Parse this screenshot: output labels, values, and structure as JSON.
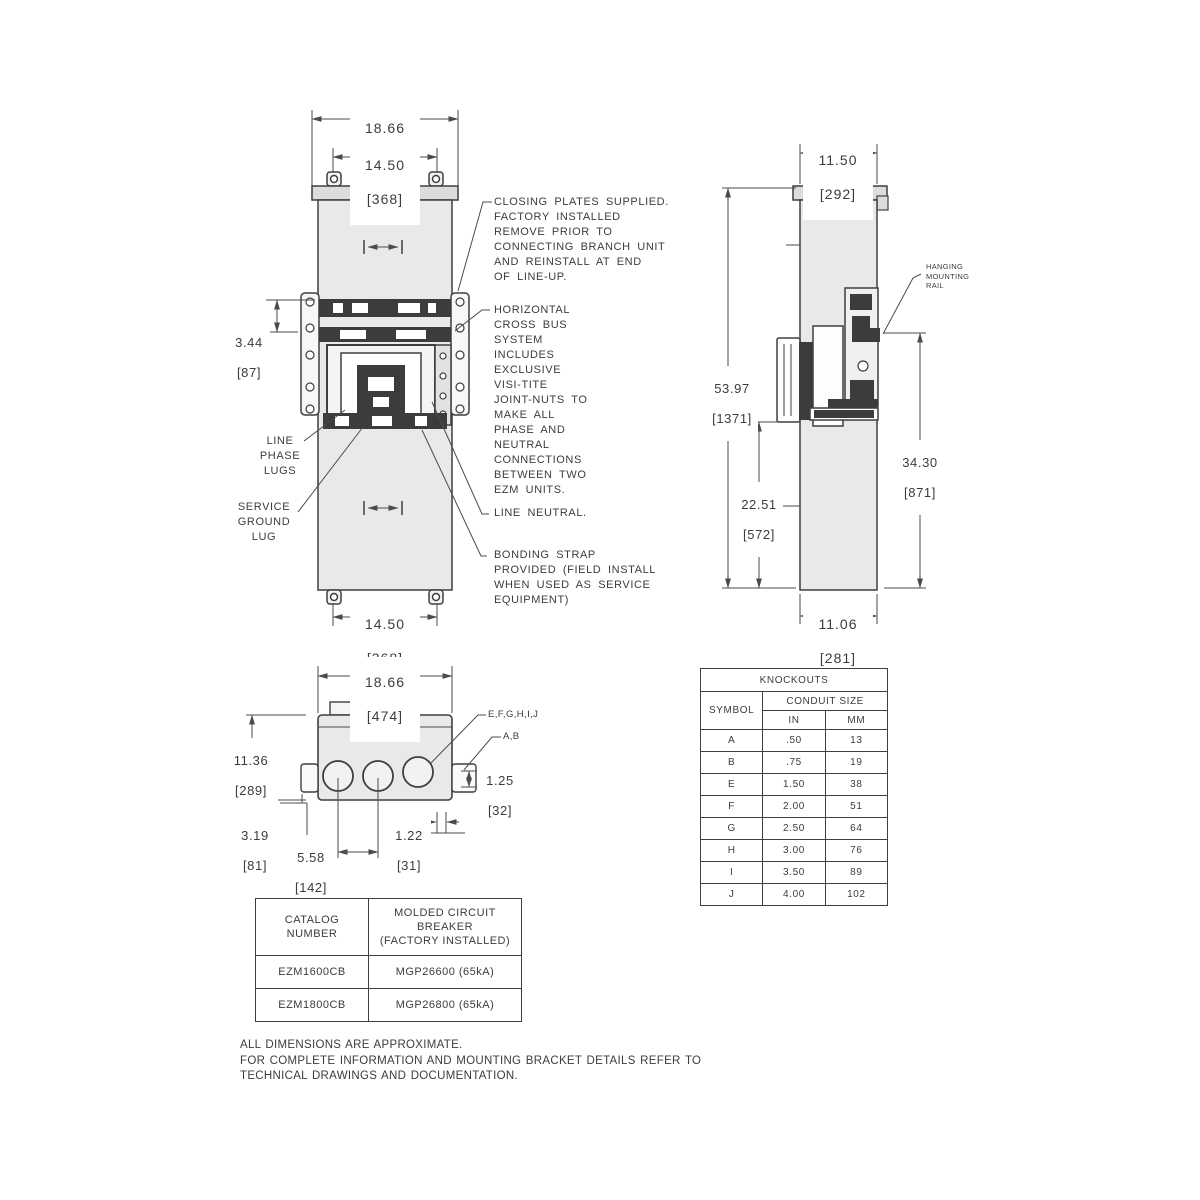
{
  "front_view": {
    "dim_width_in": "18.66",
    "dim_width_mm": "[474]",
    "dim_mount_top_in": "14.50",
    "dim_mount_top_mm": "[368]",
    "dim_lug_in": "3.44",
    "dim_lug_mm": "[87]",
    "dim_mount_bottom_in": "14.50",
    "dim_mount_bottom_mm": "[368]",
    "label_line_phase_lugs": "LINE\nPHASE\nLUGS",
    "label_service_ground_lug": "SERVICE\nGROUND\nLUG"
  },
  "annotations": {
    "closing_plates": "CLOSING PLATES SUPPLIED.\nFACTORY INSTALLED\nREMOVE PRIOR TO\nCONNECTING BRANCH UNIT\nAND REINSTALL AT END\nOF LINE-UP.",
    "cross_bus": "HORIZONTAL\nCROSS BUS\nSYSTEM\nINCLUDES\nEXCLUSIVE\nVISI-TITE\nJOINT-NUTS TO\nMAKE ALL\nPHASE AND\nNEUTRAL\nCONNECTIONS\nBETWEEN TWO\nEZM UNITS.",
    "line_neutral": "LINE NEUTRAL.",
    "bonding_strap": "BONDING STRAP\nPROVIDED (FIELD INSTALL\nWHEN USED AS SERVICE\nEQUIPMENT)"
  },
  "side_view": {
    "dim_depth_top_in": "11.50",
    "dim_depth_top_mm": "[292]",
    "dim_height_in": "53.97",
    "dim_height_mm": "[1371]",
    "dim_lower_in": "22.51",
    "dim_lower_mm": "[572]",
    "dim_rail_in": "34.30",
    "dim_rail_mm": "[871]",
    "dim_depth_bottom_in": "11.06",
    "dim_depth_bottom_mm": "[281]",
    "label_hanging_rail": "HANGING\nMOUNTING\nRAIL"
  },
  "top_view": {
    "dim_width_in": "18.66",
    "dim_width_mm": "[474]",
    "dim_depth_in": "11.36",
    "dim_depth_mm": "[289]",
    "dim_offset_in": "3.19",
    "dim_offset_mm": "[81]",
    "dim_spacing_in": "5.58",
    "dim_spacing_mm": "[142]",
    "dim_gap_in": "1.22",
    "dim_gap_mm": "[31]",
    "dim_edge_in": "1.25",
    "dim_edge_mm": "[32]",
    "label_large_knockouts": "E,F,G,H,I,J",
    "label_small_knockouts": "A,B"
  },
  "knockouts_table": {
    "title": "KNOCKOUTS",
    "col_symbol": "SYMBOL",
    "col_conduit": "CONDUIT SIZE",
    "col_in": "IN",
    "col_mm": "MM",
    "rows": [
      {
        "symbol": "A",
        "in": ".50",
        "mm": "13"
      },
      {
        "symbol": "B",
        "in": ".75",
        "mm": "19"
      },
      {
        "symbol": "E",
        "in": "1.50",
        "mm": "38"
      },
      {
        "symbol": "F",
        "in": "2.00",
        "mm": "51"
      },
      {
        "symbol": "G",
        "in": "2.50",
        "mm": "64"
      },
      {
        "symbol": "H",
        "in": "3.00",
        "mm": "76"
      },
      {
        "symbol": "I",
        "in": "3.50",
        "mm": "89"
      },
      {
        "symbol": "J",
        "in": "4.00",
        "mm": "102"
      }
    ]
  },
  "catalog_table": {
    "col_catalog": "CATALOG\nNUMBER",
    "col_breaker": "MOLDED CIRCUIT\nBREAKER\n(FACTORY INSTALLED)",
    "rows": [
      {
        "catalog": "EZM1600CB",
        "breaker": "MGP26600  (65kA)"
      },
      {
        "catalog": "EZM1800CB",
        "breaker": "MGP26800  (65kA)"
      }
    ]
  },
  "notes": "ALL DIMENSIONS ARE APPROXIMATE.\nFOR COMPLETE INFORMATION AND MOUNTING BRACKET DETAILS REFER TO\nTECHNICAL DRAWINGS AND DOCUMENTATION.",
  "colors": {
    "line": "#4b4b4b",
    "object_stroke": "#3f3f3f",
    "body_fill": "#e9e9e9",
    "cap_fill": "#dcdcdc",
    "dark_fill": "#3c3c3c"
  }
}
